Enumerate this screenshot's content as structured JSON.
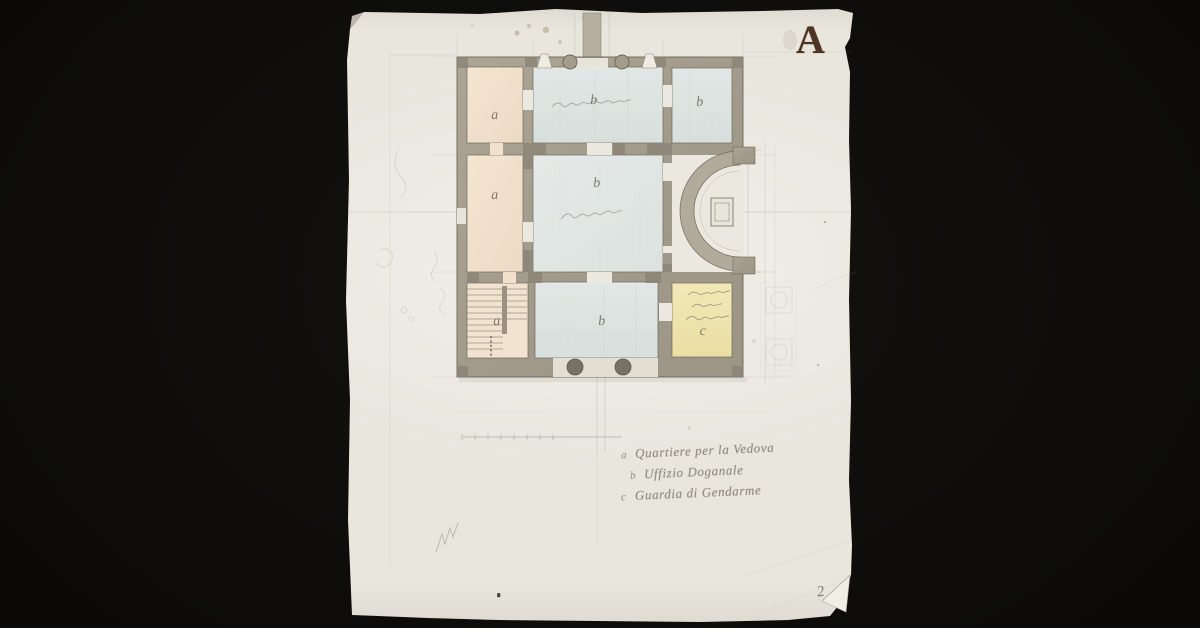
{
  "document": {
    "type": "Hand-drawn architectural floor plan, ink and watercolor wash on aged paper",
    "plate_letter": "A",
    "page_number": "2"
  },
  "rooms": [
    {
      "id": "a-upper-left",
      "label": "a"
    },
    {
      "id": "b-vestibule-top",
      "label": "b"
    },
    {
      "id": "b-upper-right",
      "label": "b"
    },
    {
      "id": "a-middle-left",
      "label": "a"
    },
    {
      "id": "b-central-hall",
      "label": "b"
    },
    {
      "id": "a-staircase",
      "label": "a"
    },
    {
      "id": "b-lower-center",
      "label": "b"
    },
    {
      "id": "c-lower-right",
      "label": "c"
    }
  ],
  "legend": {
    "items": [
      {
        "marker": "a",
        "text": "Quartiere per la Vedova"
      },
      {
        "marker": "b",
        "text": "Uffizio Doganale"
      },
      {
        "marker": "c",
        "text": "Guardia di Gendarme"
      }
    ]
  },
  "colors": {
    "background": "#0d0c0a",
    "paper": "#e9e6de",
    "wall_wash": "#a7a093",
    "room_pink": "#f1e1cd",
    "room_blue": "#dde5e2",
    "room_yellow": "#efe5ae",
    "plate_letter_ink": "#4e3422",
    "pencil": "#8b8579"
  }
}
